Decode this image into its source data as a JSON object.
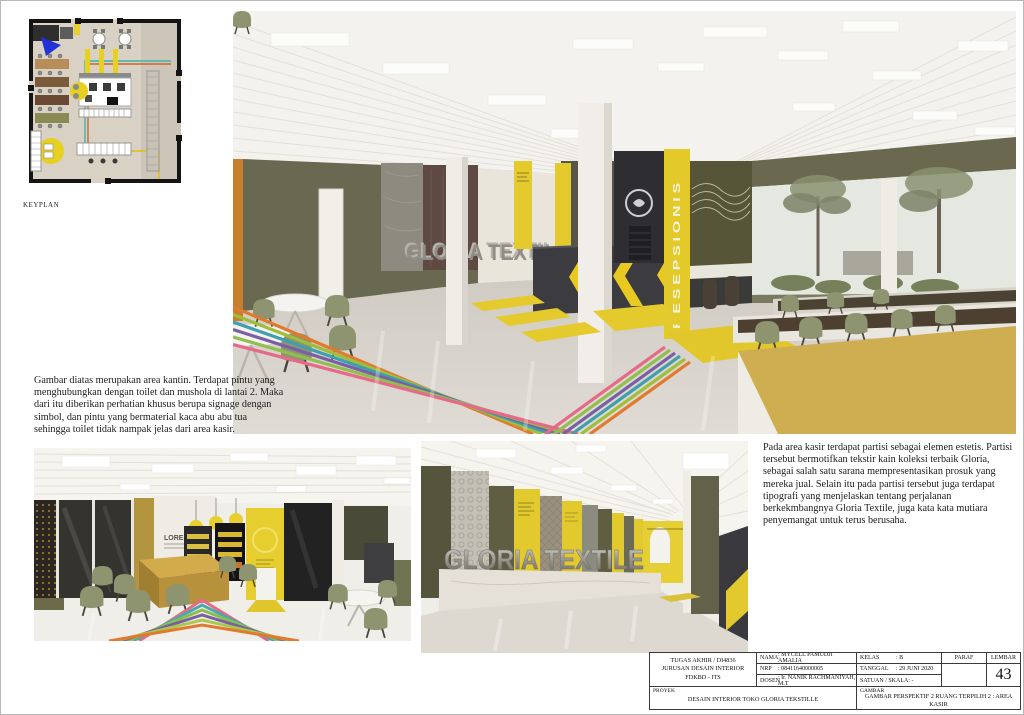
{
  "keyplan": {
    "label": "KEYPLAN"
  },
  "paragraphs": {
    "left": "Gambar diatas merupakan area kantin. Terdapat pintu yang menghubungkan dengan toilet dan mushola di lantai 2. Maka dari itu diberikan perhatian khusus berupa signage dengan simbol, dan pintu yang bermaterial kaca abu abu tua sehingga toilet tidak nampak jelas dari area kasir.",
    "right": "Pada area kasir terdapat partisi sebagai elemen estetis. Partisi tersebut bermotifkan tekstir kain koleksi terbaik Gloria, sebagai salah satu sarana mempresentasikan prosuk yang mereka jual. Selain itu pada partisi tersebut juga terdapat tipografi yang menjelaskan tentang perjalanan berkekmbangnya Gloria Textile, juga kata kata mutiara penyemangat untuk terus berusaha."
  },
  "renders": {
    "main": {
      "signage": "GLORIA TEXTILE",
      "receptionist_sign": "RESEPSIONIS"
    },
    "cashier": {
      "signage": "GLORIA TEXTILE"
    },
    "canteen": {
      "wall_text": "LOREM",
      "wall_subtext": "AREA"
    }
  },
  "titleblock": {
    "institution_line1": "TUGAS AKHIR / DI4836",
    "institution_line2": "JURUSAN DESAIN INTERIOR",
    "institution_line3": "FDKBD - ITS",
    "nama_label": "NAMA",
    "nama_value": ": MYCELL PAMUDJI AMALIA",
    "nrp_label": "NRP",
    "nrp_value": ": 08411640000005",
    "dosen_label": "DOSEN",
    "dosen_value": ": Ir. NANIK RACHMANIYAH, M.T",
    "kelas_label": "KELAS",
    "kelas_value": ": B",
    "tanggal_label": "TANGGAL",
    "tanggal_value": ": 29 JUNI 2020",
    "satuan_label": "SATUAN / SKALA",
    "satuan_value": ": -",
    "paraf_label": "PARAF",
    "lembar_label": "LEMBAR",
    "lembar_value": "43",
    "proyek_label": "PROYEK",
    "proyek_value": "DESAIN INTERIOR TOKO GLORIA TEKSTILLE",
    "gambar_label": "GAMBAR",
    "gambar_value": "GAMBAR PERSPEKTIF 2  RUANG TERPILIH 2 : AREA KASIR"
  },
  "colors": {
    "accent_yellow": "#e3c92d",
    "olive_wall": "#696851",
    "dark_counter": "#3b3b40",
    "stripe_orange": "#e2792f",
    "stripe_green": "#8fbf4f",
    "stripe_teal": "#3f9fae",
    "stripe_purple": "#7b5fa5",
    "stripe_lightgreen": "#9dbf3b",
    "stripe_pink": "#e66a88"
  }
}
